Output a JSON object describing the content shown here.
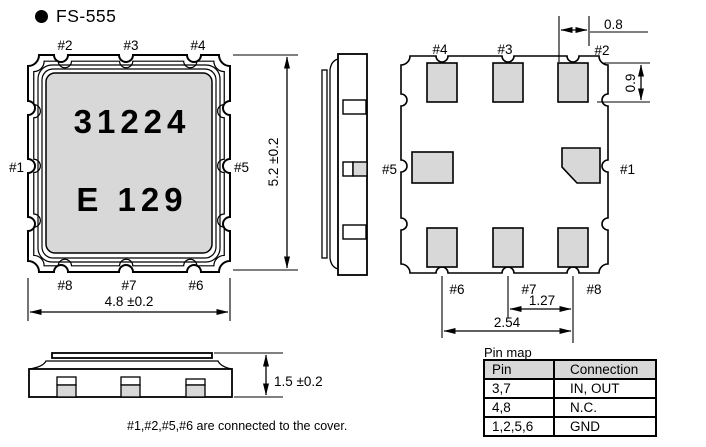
{
  "title": "FS-555",
  "colors": {
    "line": "#000000",
    "pad_fill": "#d8d8d8",
    "marking_bg": "#d8d8d8"
  },
  "top_view": {
    "marking_line1": "31224",
    "marking_line2": "E 129",
    "pin_top": [
      "#2",
      "#3",
      "#4"
    ],
    "pin_left": "#1",
    "pin_right": "#5",
    "pin_bottom": [
      "#8",
      "#7",
      "#6"
    ],
    "dim_width": "4.8 ±0.2",
    "dim_height": "5.2 ±0.2"
  },
  "bottom_view": {
    "pin_top": [
      "#4",
      "#3",
      "#2"
    ],
    "pin_left": "#5",
    "pin_right": "#1",
    "pin_bottom": [
      "#6",
      "#7",
      "#8"
    ],
    "dim_pad_width": "0.8",
    "dim_pad_height": "0.9",
    "dim_pitch": "1.27",
    "dim_span": "2.54"
  },
  "front_view": {
    "dim_height": "1.5 ±0.2"
  },
  "note": "#1,#2,#5,#6 are connected to the cover.",
  "pin_map": {
    "caption": "Pin map",
    "headers": [
      "Pin",
      "Connection"
    ],
    "rows": [
      [
        "3,7",
        "IN, OUT"
      ],
      [
        "4,8",
        "N.C."
      ],
      [
        "1,2,5,6",
        "GND"
      ]
    ]
  }
}
